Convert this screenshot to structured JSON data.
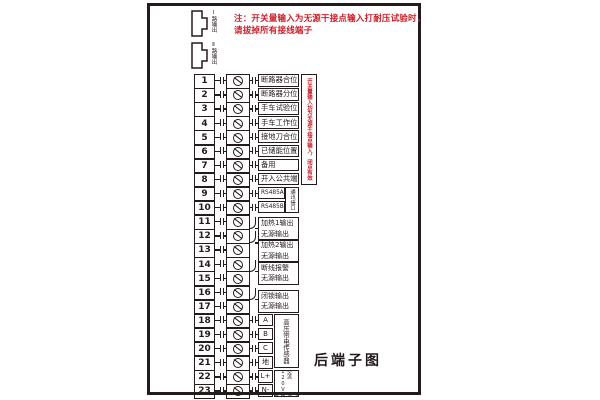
{
  "title": "后端子图",
  "note": {
    "line1": "注：开关量输入为无源干接点输入打耐压试验时，",
    "line2": "请拔掉所有接线端子"
  },
  "side_note_vertical": "开关量输入均为无源干接点输入，闭点有效",
  "connectors": [
    {
      "label": "Ⅰ路输出"
    },
    {
      "label": "Ⅱ路输出"
    }
  ],
  "terminals": [
    {
      "no": "1",
      "label": "断路器合位"
    },
    {
      "no": "2",
      "label": "断路器分位"
    },
    {
      "no": "3",
      "label": "手车试验位"
    },
    {
      "no": "4",
      "label": "手车工作位"
    },
    {
      "no": "5",
      "label": "接地刀合位"
    },
    {
      "no": "6",
      "label": "已储能位置"
    },
    {
      "no": "7",
      "label": "备用"
    },
    {
      "no": "8",
      "label": "开入公共端"
    },
    {
      "no": "9",
      "label": "RS485A"
    },
    {
      "no": "10",
      "label": "RS485B"
    },
    {
      "no": "11",
      "label": ""
    },
    {
      "no": "12",
      "label": ""
    },
    {
      "no": "13",
      "label": ""
    },
    {
      "no": "14",
      "label": ""
    },
    {
      "no": "15",
      "label": ""
    },
    {
      "no": "16",
      "label": ""
    },
    {
      "no": "17",
      "label": ""
    },
    {
      "no": "18",
      "label": "A"
    },
    {
      "no": "19",
      "label": "B"
    },
    {
      "no": "20",
      "label": "C"
    },
    {
      "no": "21",
      "label": "地"
    },
    {
      "no": "22",
      "label": "L+"
    },
    {
      "no": "23",
      "label": "N-"
    }
  ],
  "output_groups": [
    {
      "rows": "11-12",
      "label": "加热1输出",
      "sub": "无源输出"
    },
    {
      "rows": "12-13",
      "label": "加热2输出",
      "sub": "无源输出"
    },
    {
      "rows": "14-15",
      "label": "断线报警",
      "sub": "无源输出"
    },
    {
      "rows": "16-17",
      "label": "闭锁输出",
      "sub": "无源输出"
    }
  ],
  "side_boxes": [
    {
      "rows": "9-10",
      "label": "通讯接口"
    },
    {
      "rows": "18-21",
      "label": "高压带电传感器"
    },
    {
      "rows": "22-23",
      "label_col_right": "交流220V",
      "label_col_left": "装置电源"
    }
  ],
  "colors": {
    "note_red": "#c9202a",
    "ink": "#241b1d"
  }
}
